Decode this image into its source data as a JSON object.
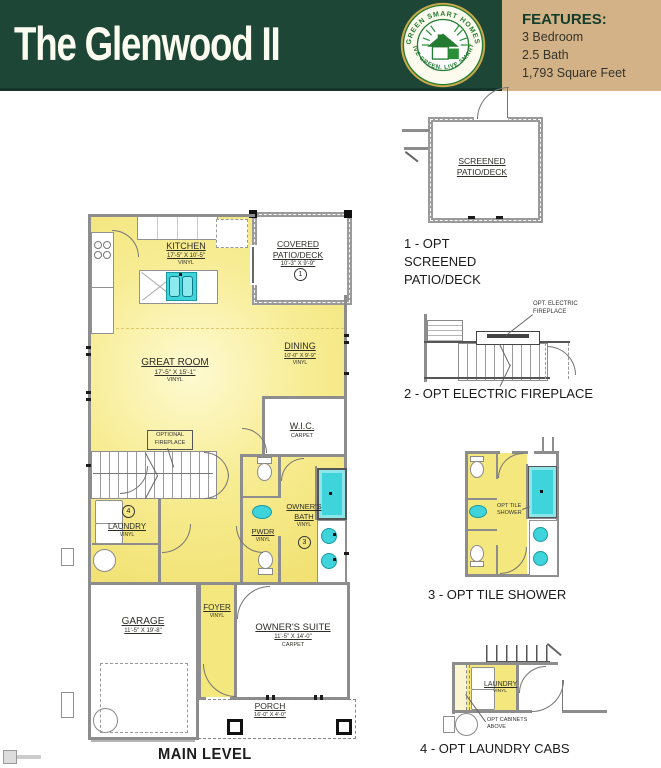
{
  "header": {
    "title": "The Glenwood II",
    "logo": {
      "arc_top": "GREEN SMART HOMES",
      "arc_bottom": "LIVE GREEN. LIVE SMART."
    },
    "features": {
      "heading": "FEATURES:",
      "items": [
        "3 Bedroom",
        "2.5 Bath",
        "1,793 Square Feet"
      ]
    }
  },
  "plan": {
    "caption": "MAIN LEVEL",
    "kitchen": {
      "name": "KITCHEN",
      "dims": "17'-5\" X 10'-5\"",
      "floor": "VINYL"
    },
    "covered_patio": {
      "name": "COVERED PATIO/DECK",
      "dims": "10'-3\" X 9'-9\"",
      "marker": "1"
    },
    "great_room": {
      "name": "GREAT ROOM",
      "dims": "17'-5\" X 15'-1\"",
      "floor": "VINYL"
    },
    "dining": {
      "name": "DINING",
      "dims": "10'-0\" X 9'-9\"",
      "floor": "VINYL"
    },
    "wic": {
      "name": "W.I.C.",
      "floor": "CARPET"
    },
    "optional_fireplace": {
      "label": "OPTIONAL FIREPLACE"
    },
    "laundry": {
      "name": "LAUNDRY",
      "floor": "VINYL",
      "marker": "4"
    },
    "pwdr": {
      "name": "PWDR",
      "floor": "VINYL"
    },
    "owners_bath": {
      "name": "OWNER'S BATH",
      "floor": "VINYL",
      "marker": "3"
    },
    "garage": {
      "name": "GARAGE",
      "dims": "11'-5\" X 19'-8\""
    },
    "foyer": {
      "name": "FOYER",
      "floor": "VINYL"
    },
    "owners_suite": {
      "name": "OWNER'S SUITE",
      "dims": "11'-5\" X 14'-0\"",
      "floor": "CARPET"
    },
    "porch": {
      "name": "PORCH",
      "dims": "16'-0\" X 4'-0\""
    }
  },
  "options": [
    {
      "caption": "1 - OPT SCREENED PATIO/DECK",
      "room_label": "SCREENED PATIO/DECK"
    },
    {
      "caption": "2 - OPT ELECTRIC FIREPLACE",
      "callout": "OPT. ELECTRIC FIREPLACE"
    },
    {
      "caption": "3 - OPT TILE SHOWER",
      "callout": "OPT TILE SHOWER"
    },
    {
      "caption": "4 - OPT LAUNDRY CABS",
      "room_label": "LAUNDRY",
      "room_floor": "VINYL",
      "callout": "OPT CABINETS ABOVE"
    }
  ],
  "colors": {
    "header_green": "#1e4636",
    "features_tan": "#d3b287",
    "floor_yellow": "#f3e272",
    "fixture_teal": "#3fd4db",
    "wall_gray": "#8d8d8d",
    "logo_green": "#237a31"
  }
}
